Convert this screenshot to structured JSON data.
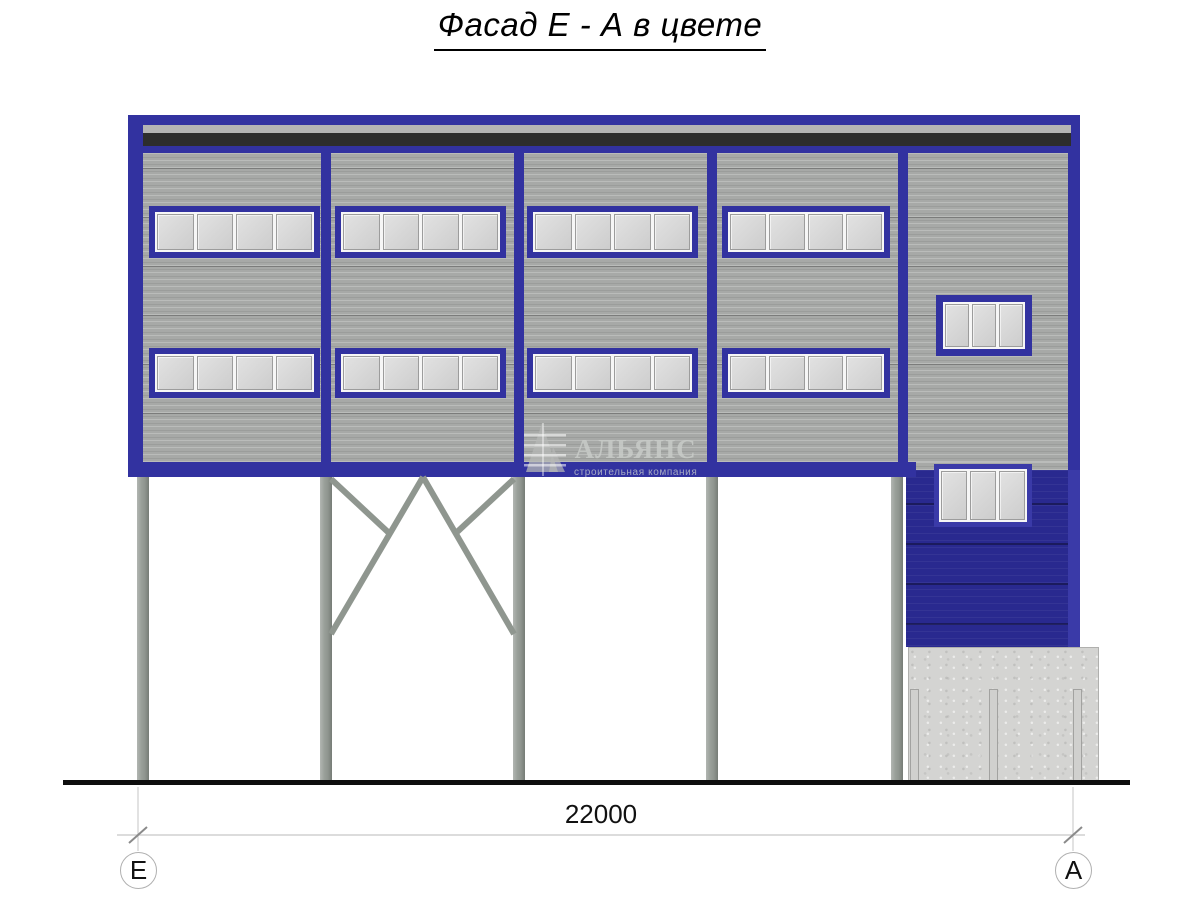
{
  "title": "Фасад Е - А в цвете",
  "dimension": {
    "label": "22000",
    "axis_left": "Е",
    "axis_right": "А"
  },
  "watermark": {
    "name": "АЛЬЯНС",
    "subtitle": "строительная компания"
  },
  "windows": {
    "large_strip_panes": 4,
    "small_window_panes": 3,
    "large_strip_count": 8,
    "small_window_count": 2
  },
  "colors": {
    "frame_blue": "#3232a0",
    "wall_blue": "#29298f",
    "panel_gray": "#a7a9a7",
    "dark_flashing": "#2d2d2d",
    "column_gray": "#9aa09a",
    "concrete": "#d4d4d2",
    "glass": "#d8d8d8"
  }
}
